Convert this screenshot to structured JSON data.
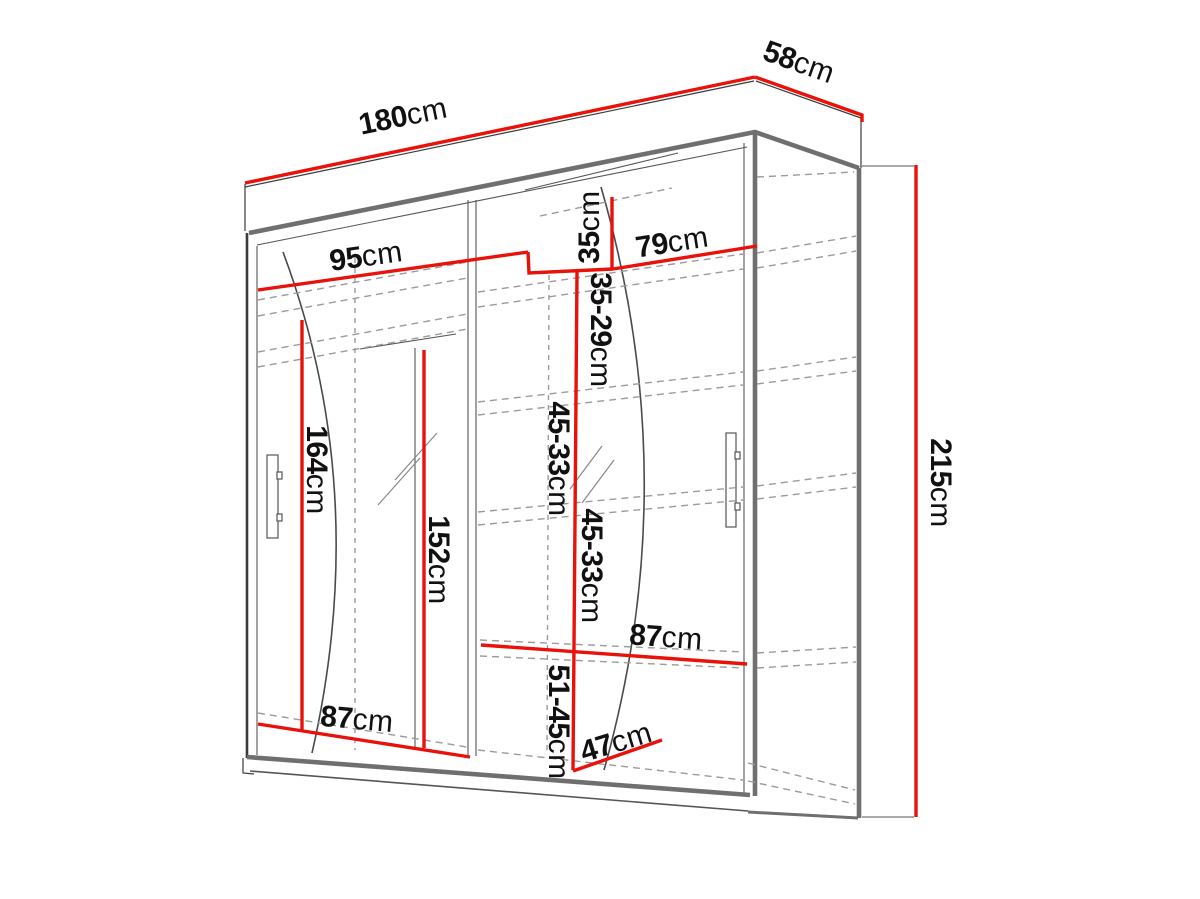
{
  "diagram": {
    "type": "wardrobe-technical-drawing",
    "unit": "cm",
    "colors": {
      "dimension_line": "#e8120b",
      "outline": "#3a3a3a",
      "panel_thick": "#6f6f6f",
      "hidden_dashed": "#9b9b9b"
    },
    "dimensions": {
      "overall_width": {
        "value": "180",
        "unit": "cm"
      },
      "overall_depth": {
        "value": "58",
        "unit": "cm"
      },
      "overall_height": {
        "value": "215",
        "unit": "cm"
      },
      "left_section_width": {
        "value": "95",
        "unit": "cm"
      },
      "right_section_top_width": {
        "value": "79",
        "unit": "cm"
      },
      "top_compartment_height": {
        "value": "35",
        "unit": "cm"
      },
      "upper_shelf_spacing": {
        "value": "35-29",
        "unit": "cm"
      },
      "middle_shelf_spacing_upper": {
        "value": "45-33",
        "unit": "cm"
      },
      "middle_shelf_spacing_lower": {
        "value": "45-33",
        "unit": "cm"
      },
      "bottom_compartment_height": {
        "value": "51-45",
        "unit": "cm"
      },
      "left_hanging_height": {
        "value": "164",
        "unit": "cm"
      },
      "mirror_height": {
        "value": "152",
        "unit": "cm"
      },
      "left_section_bottom_width": {
        "value": "87",
        "unit": "cm"
      },
      "right_shelf_width": {
        "value": "87",
        "unit": "cm"
      },
      "bottom_shelf_depth": {
        "value": "47",
        "unit": "cm"
      }
    }
  }
}
